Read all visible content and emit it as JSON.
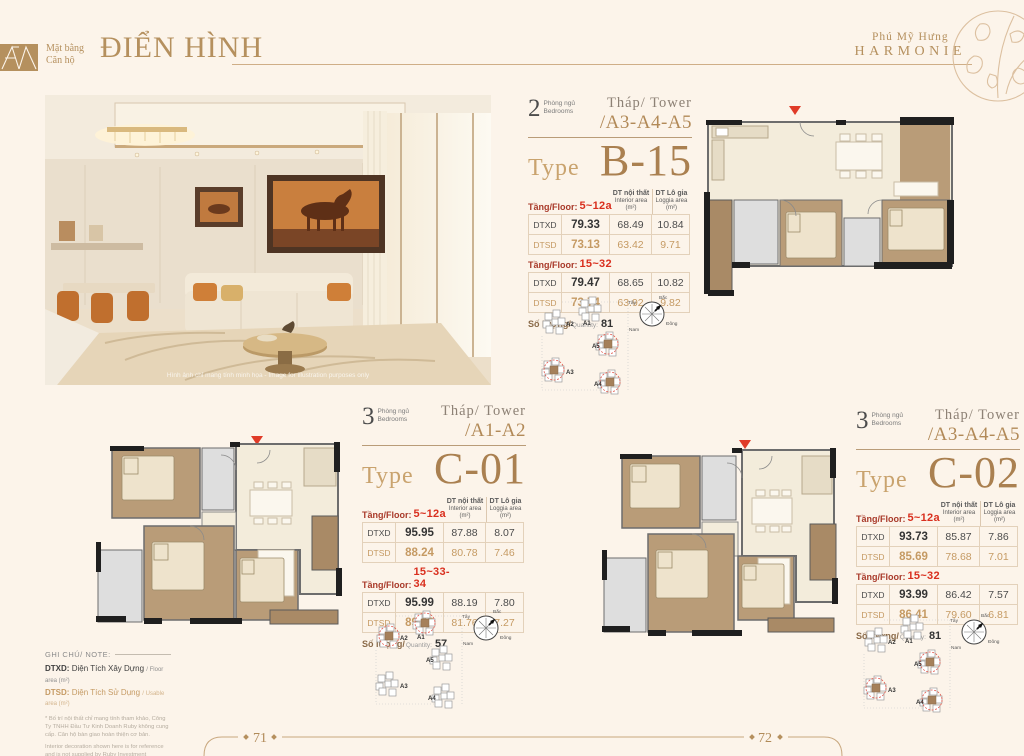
{
  "colors": {
    "accent": "#b28a58",
    "accent_light": "#c9a36e",
    "red_marker": "#e03b28",
    "floor_red": "#d92f1e",
    "dtsd_tan": "#c59a63",
    "dark": "#4a4a4a",
    "background": "#fcf4ea"
  },
  "header": {
    "logo_line1": "Mặt bằng",
    "logo_line2": "Căn hộ",
    "title": "ĐIỂN HÌNH",
    "brand_top": "Phú Mỹ Hưng",
    "brand_name": "HARMONIE"
  },
  "photo": {
    "watermark": "Hình ảnh chỉ mang tính minh họa - Image for illustration purposes only"
  },
  "labels": {
    "tower": "Tháp/ Tower",
    "type": "Type",
    "floor": "Tầng/Floor:",
    "col_interior_vi": "DT nội thất",
    "col_interior_en": "Interior area",
    "col_unit": "(m²)",
    "col_loggia_vi": "DT Lô gia",
    "col_loggia_en": "Loggia area",
    "row_dtxd": "DTXD",
    "row_dtsd": "DTSD",
    "qty_vi": "Số lượng/",
    "qty_en": "Quantity:"
  },
  "units": [
    {
      "bedrooms": "2",
      "bedrooms_vi": "Phòng ngủ",
      "bedrooms_en": "Bedrooms",
      "towers": "/A3-A4-A5",
      "type_name": "B-15",
      "groups": [
        {
          "floors": "5~12a",
          "dtxd": [
            "79.33",
            "68.49",
            "10.84"
          ],
          "dtsd": [
            "73.13",
            "63.42",
            "9.71"
          ]
        },
        {
          "floors": "15~32",
          "dtxd": [
            "79.47",
            "68.65",
            "10.82"
          ],
          "dtsd": [
            "73.74",
            "63.92",
            "9.82"
          ]
        }
      ],
      "quantity": "81"
    },
    {
      "bedrooms": "3",
      "bedrooms_vi": "Phòng ngủ",
      "bedrooms_en": "Bedrooms",
      "towers": "/A1-A2",
      "type_name": "C-01",
      "groups": [
        {
          "floors": "5~12a",
          "dtxd": [
            "95.95",
            "87.88",
            "8.07"
          ],
          "dtsd": [
            "88.24",
            "80.78",
            "7.46"
          ]
        },
        {
          "floors": "15~33-34",
          "dtxd": [
            "95.99",
            "88.19",
            "7.80"
          ],
          "dtsd": [
            "89.03",
            "81.76",
            "7.27"
          ]
        }
      ],
      "quantity": "57"
    },
    {
      "bedrooms": "3",
      "bedrooms_vi": "Phòng ngủ",
      "bedrooms_en": "Bedrooms",
      "towers": "/A3-A4-A5",
      "type_name": "C-02",
      "groups": [
        {
          "floors": "5~12a",
          "dtxd": [
            "93.73",
            "85.87",
            "7.86"
          ],
          "dtsd": [
            "85.69",
            "78.68",
            "7.01"
          ]
        },
        {
          "floors": "15~32",
          "dtxd": [
            "93.99",
            "86.42",
            "7.57"
          ],
          "dtsd": [
            "86.41",
            "79.60",
            "6.81"
          ]
        }
      ],
      "quantity": "81"
    }
  ],
  "keyplan": {
    "towers": [
      "A1",
      "A2",
      "A3",
      "A4",
      "A5"
    ],
    "compass_n": "Bắc",
    "compass_e": "Đông",
    "compass_s": "Nam",
    "compass_w": "Tây"
  },
  "notes": {
    "heading": "GHI CHÚ/ NOTE:",
    "dtxd_term": "DTXD:",
    "dtxd_vi": "Diện Tích Xây Dựng",
    "dtxd_en": "/ Floor area (m²)",
    "dtsd_term": "DTSD:",
    "dtsd_vi": "Diện Tích Sử Dụng",
    "dtsd_en": "/ Usable area (m²)",
    "fine_vi": "* Bố trí nội thất chỉ mang tính tham khảo, Công Ty TNHH Đầu Tư Kinh Doanh Ruby không cung cấp. Căn hộ bàn giao hoàn thiện cơ bản.",
    "fine_en": "Interior decoration shown here is for reference and is not supplied by Ruby Investment Business Company Limited. The apartments are standard - style handover."
  },
  "footer": {
    "page_left": "71",
    "page_right": "72"
  }
}
